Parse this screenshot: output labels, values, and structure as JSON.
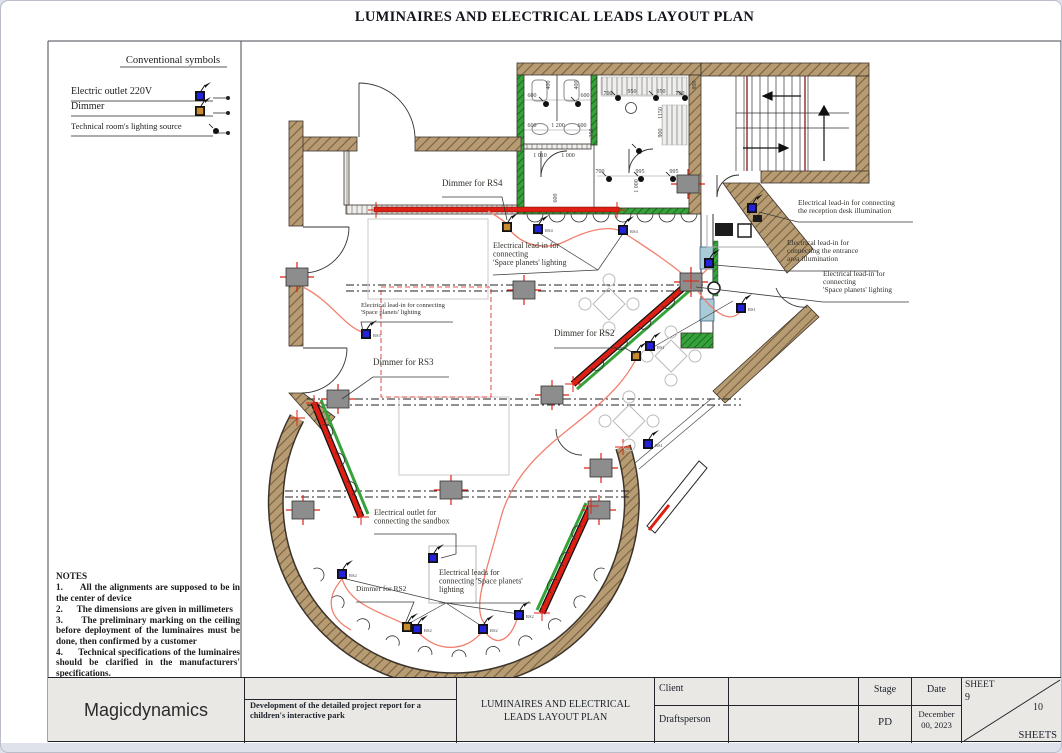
{
  "page": {
    "title": "LUMINAIRES AND ELECTRICAL LEADS LAYOUT PLAN"
  },
  "legend": {
    "title": "Conventional symbols",
    "items": [
      {
        "label": "Electric outlet 220V",
        "icon": "outlet-220v-symbol"
      },
      {
        "label": "Dimmer",
        "icon": "dimmer-symbol"
      },
      {
        "label": "Technical room's lighting source",
        "icon": "tech-room-light-symbol"
      }
    ]
  },
  "notes": {
    "title": "NOTES",
    "items": [
      "1.      All the alignments are supposed to be in the center of device",
      "2.      The dimensions are given in millimeters",
      "3.      The preliminary marking on the ceiling before deployment of the luminaires must be done, then confirmed by a customer",
      "4.      Technical specifications of the luminaires should be clarified in the manufacturers' specifications."
    ]
  },
  "plan": {
    "colors": {
      "wall": "#b79c73",
      "wall_hatch": "#77603f",
      "accent_green": "#35a339",
      "track_red": "#dd1f14",
      "cable_red": "#f0806d",
      "outlet_blue": "#2222dd",
      "dimmer_orange": "#c98a2e",
      "junction_gray": "#8d8d8d",
      "window_blue": "#a9cbd8",
      "cross_red": "#dd2211"
    },
    "labels": [
      {
        "lines": [
          "Dimmer for RS4"
        ],
        "x": 441,
        "y": 185,
        "s": 9,
        "lead": [
          [
            441,
            196
          ],
          [
            501,
            196
          ],
          [
            506,
            219
          ]
        ]
      },
      {
        "lines": [
          "Electrical lead-in for",
          "connecting",
          "'Space planets' lighting"
        ],
        "x": 492,
        "y": 247,
        "s": 8,
        "lead": [
          [
            492,
            274
          ],
          [
            597,
            269
          ]
        ]
      },
      {
        "lines": [
          "Electrical lead-in for connecting",
          "the reception desk illumination"
        ],
        "x": 797,
        "y": 204,
        "s": 7.5,
        "lead": [
          [
            912,
            221
          ],
          [
            797,
            221
          ],
          [
            758,
            211
          ]
        ]
      },
      {
        "lines": [
          "Electrical lead-in for",
          "connecting the entrance",
          "area illumination"
        ],
        "x": 786,
        "y": 244,
        "s": 7.5,
        "lead": [
          [
            877,
            270
          ],
          [
            786,
            270
          ],
          [
            713,
            264
          ]
        ]
      },
      {
        "lines": [
          "Electrical lead-in for",
          "connecting",
          "'Space planets' lighting"
        ],
        "x": 822,
        "y": 275,
        "s": 7.5,
        "lead": [
          [
            908,
            301
          ],
          [
            822,
            301
          ],
          [
            695,
            286
          ]
        ]
      },
      {
        "lines": [
          "Electrical lead-in for connecting",
          "'Space planets' lighting"
        ],
        "x": 360,
        "y": 306,
        "s": 6.5,
        "lead": [
          [
            452,
            321
          ],
          [
            360,
            321
          ],
          [
            362,
            330
          ]
        ]
      },
      {
        "lines": [
          "Dimmer for RS3"
        ],
        "x": 372,
        "y": 364,
        "s": 9,
        "lead": [
          [
            448,
            376
          ],
          [
            372,
            376
          ],
          [
            341,
            398
          ]
        ]
      },
      {
        "lines": [
          "Dimmer for RS2"
        ],
        "x": 553,
        "y": 335,
        "s": 9,
        "lead": [
          [
            553,
            347
          ],
          [
            624,
            347
          ],
          [
            634,
            353
          ]
        ]
      },
      {
        "lines": [
          "Electrical outlet for",
          "connecting the sandbox"
        ],
        "x": 373,
        "y": 514,
        "s": 8,
        "lead": [
          [
            373,
            533
          ],
          [
            455,
            533
          ],
          [
            455,
            553
          ],
          [
            440,
            557
          ]
        ]
      },
      {
        "lines": [
          "Electrical leads for",
          "connecting 'Space planets'",
          "lighting"
        ],
        "x": 438,
        "y": 574,
        "s": 8,
        "lead": [
          [
            438,
            602
          ],
          [
            530,
            602
          ]
        ]
      },
      {
        "lines": [
          "Dimmer for RS2"
        ],
        "x": 355,
        "y": 590,
        "s": 7.5,
        "lead": [
          [
            355,
            601
          ],
          [
            413,
            601
          ],
          [
            404,
            623
          ]
        ]
      }
    ],
    "fans": [
      [
        [
          445,
          602
        ],
        [
          341,
          577
        ]
      ],
      [
        [
          445,
          602
        ],
        [
          407,
          623
        ]
      ],
      [
        [
          445,
          602
        ],
        [
          482,
          626
        ]
      ],
      [
        [
          445,
          602
        ],
        [
          518,
          613
        ]
      ],
      [
        [
          597,
          269
        ],
        [
          538,
          232
        ]
      ],
      [
        [
          597,
          269
        ],
        [
          623,
          231
        ]
      ],
      [
        [
          649,
          348
        ],
        [
          732,
          300
        ]
      ]
    ],
    "outlets": [
      {
        "x": 537,
        "y": 228,
        "tag": "RS4"
      },
      {
        "x": 622,
        "y": 229,
        "tag": "RS4"
      },
      {
        "x": 365,
        "y": 333,
        "tag": "RS3"
      },
      {
        "x": 649,
        "y": 345,
        "tag": "RS1"
      },
      {
        "x": 740,
        "y": 307,
        "tag": "RS1"
      },
      {
        "x": 647,
        "y": 443,
        "tag": "RS1"
      },
      {
        "x": 751,
        "y": 207,
        "tag": ""
      },
      {
        "x": 708,
        "y": 262,
        "tag": ""
      },
      {
        "x": 341,
        "y": 573,
        "tag": "RS2"
      },
      {
        "x": 416,
        "y": 628,
        "tag": "RS2"
      },
      {
        "x": 482,
        "y": 628,
        "tag": "RS2"
      },
      {
        "x": 518,
        "y": 614,
        "tag": "RS2"
      },
      {
        "x": 432,
        "y": 557,
        "tag": ""
      }
    ],
    "dimmers": [
      {
        "x": 506,
        "y": 226
      },
      {
        "x": 635,
        "y": 355
      },
      {
        "x": 406,
        "y": 626
      }
    ],
    "boxes": [
      [
        296,
        276
      ],
      [
        523,
        289
      ],
      [
        690,
        281
      ],
      [
        687,
        183
      ],
      [
        337,
        398
      ],
      [
        551,
        394
      ],
      [
        450,
        489
      ],
      [
        600,
        467
      ],
      [
        302,
        509
      ],
      [
        598,
        509
      ]
    ],
    "techdots": [
      [
        545,
        103
      ],
      [
        577,
        103
      ],
      [
        617,
        97
      ],
      [
        655,
        97
      ],
      [
        684,
        97
      ],
      [
        608,
        178
      ],
      [
        640,
        178
      ],
      [
        672,
        178
      ],
      [
        638,
        150
      ]
    ],
    "dims": [
      {
        "t": "600",
        "x": 531,
        "y": 96,
        "r": 0
      },
      {
        "t": "400",
        "x": 549,
        "y": 84,
        "r": 1
      },
      {
        "t": "400",
        "x": 577,
        "y": 84,
        "r": 1
      },
      {
        "t": "600",
        "x": 584,
        "y": 96,
        "r": 0
      },
      {
        "t": "700",
        "x": 607,
        "y": 94,
        "r": 0
      },
      {
        "t": "950",
        "x": 631,
        "y": 92,
        "r": 0
      },
      {
        "t": "950",
        "x": 660,
        "y": 92,
        "r": 0
      },
      {
        "t": "700",
        "x": 679,
        "y": 94,
        "r": 0
      },
      {
        "t": "800",
        "x": 695,
        "y": 84,
        "r": 1
      },
      {
        "t": "1150",
        "x": 661,
        "y": 112,
        "r": 1
      },
      {
        "t": "600",
        "x": 531,
        "y": 126,
        "r": 0
      },
      {
        "t": "1 200",
        "x": 557,
        "y": 126,
        "r": 0
      },
      {
        "t": "600",
        "x": 581,
        "y": 126,
        "r": 0
      },
      {
        "t": "350",
        "x": 592,
        "y": 132,
        "r": 1
      },
      {
        "t": "900",
        "x": 661,
        "y": 132,
        "r": 1
      },
      {
        "t": "1 010",
        "x": 539,
        "y": 156,
        "r": 0
      },
      {
        "t": "1 000",
        "x": 567,
        "y": 156,
        "r": 0
      },
      {
        "t": "600",
        "x": 556,
        "y": 197,
        "r": 1
      },
      {
        "t": "1 000",
        "x": 637,
        "y": 185,
        "r": 1
      },
      {
        "t": "700",
        "x": 599,
        "y": 172,
        "r": 0
      },
      {
        "t": "995",
        "x": 639,
        "y": 172,
        "r": 0
      },
      {
        "t": "995",
        "x": 673,
        "y": 172,
        "r": 0
      }
    ],
    "tables": [
      [
        608,
        303
      ],
      [
        670,
        355
      ],
      [
        628,
        420
      ]
    ]
  },
  "titleblock": {
    "company": "Magicdynamics",
    "project": "Development of the detailed project report for a children's interactive park",
    "drawing_title": "LUMINAIRES AND ELECTRICAL LEADS LAYOUT PLAN",
    "client_label": "Client",
    "draftsperson_label": "Draftsperson",
    "stage_label": "Stage",
    "stage_value": "PD",
    "date_label": "Date",
    "date_value": "December 00, 2023",
    "sheet_label": "SHEET",
    "sheet_number": "9",
    "sheets_total": "10",
    "sheets_label": "SHEETS"
  }
}
